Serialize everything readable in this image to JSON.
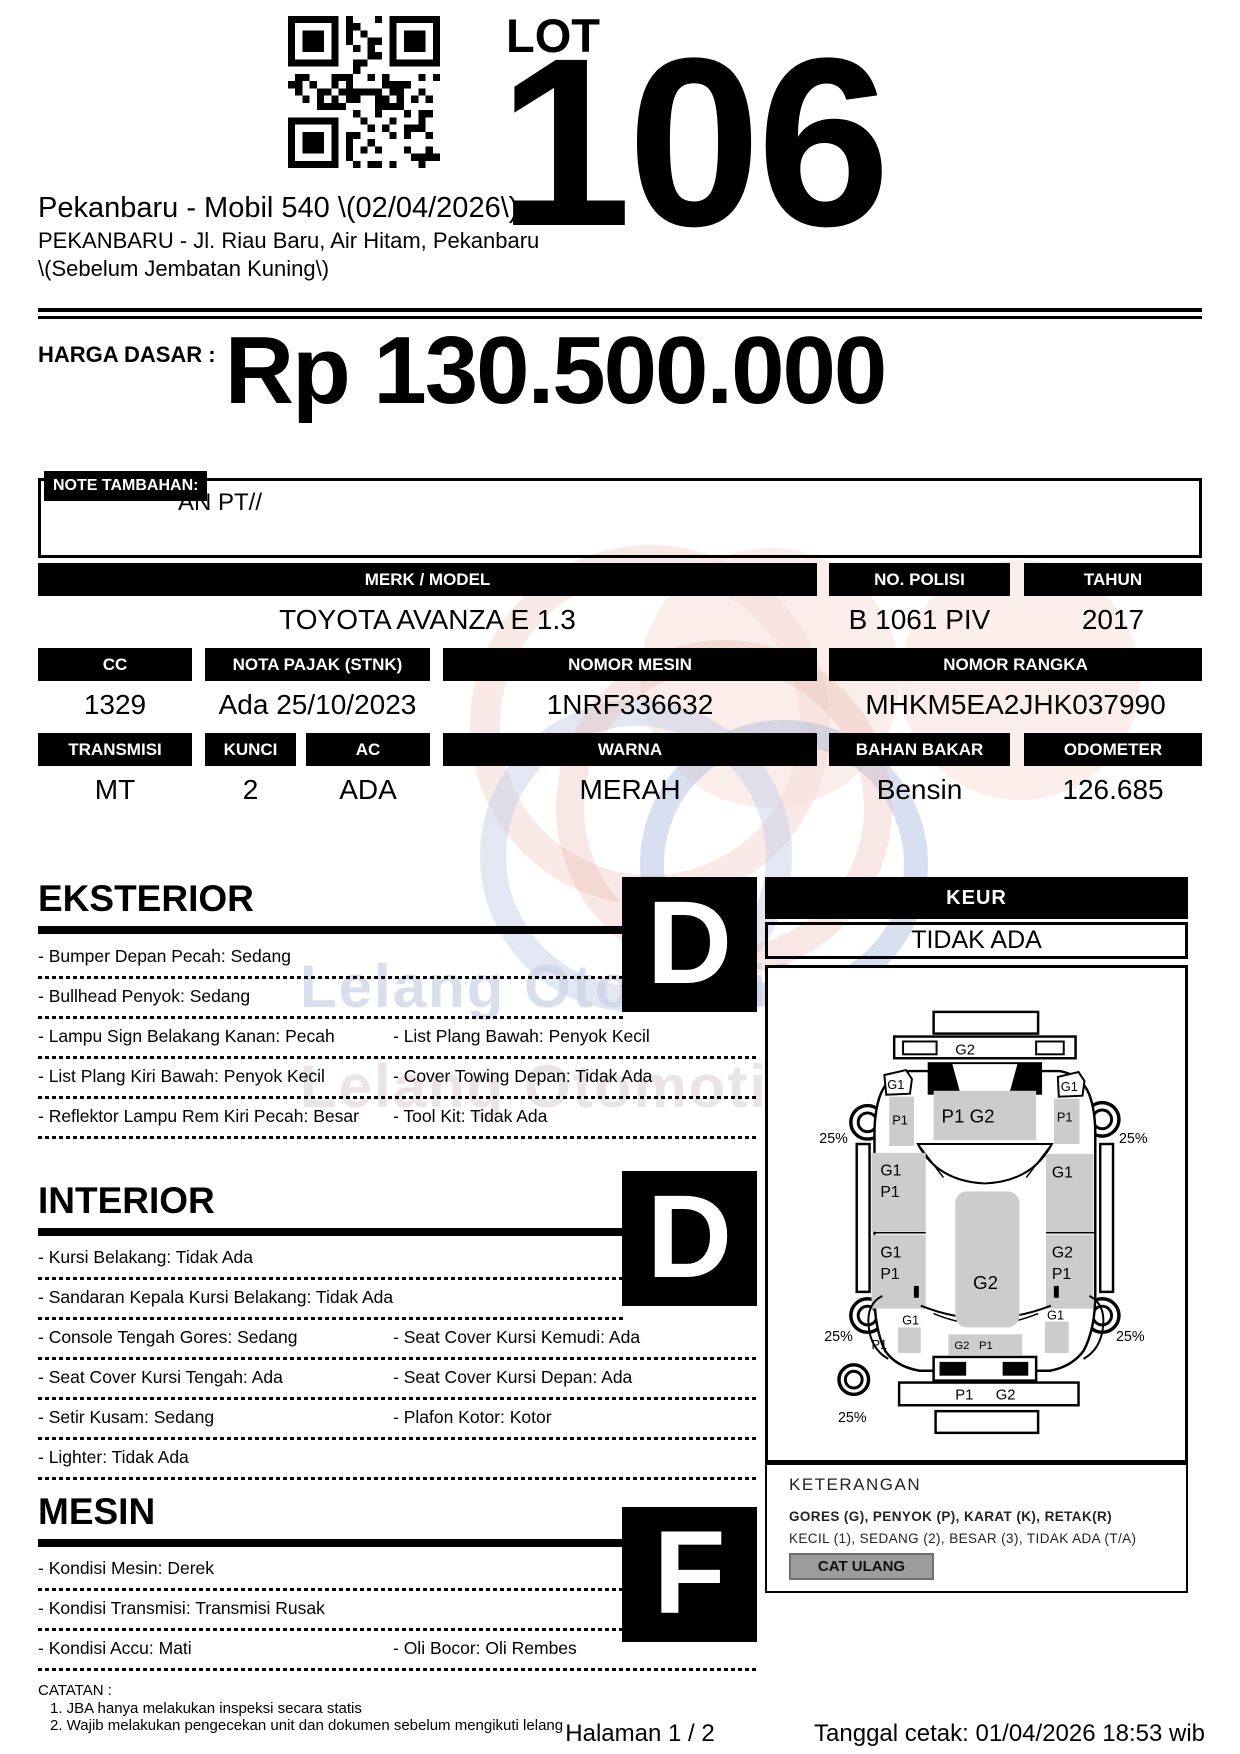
{
  "header": {
    "lot_label": "LOT",
    "lot_number": "106",
    "title_line1": "Pekanbaru - Mobil 540 \\(02/04/2026\\)",
    "title_line2": "PEKANBARU - Jl. Riau Baru, Air Hitam, Pekanbaru",
    "title_line3": "\\(Sebelum Jembatan Kuning\\)"
  },
  "price": {
    "label": "HARGA DASAR :",
    "value": "Rp 130.500.000"
  },
  "note": {
    "label": "NOTE TAMBAHAN:",
    "value": "AN PT//"
  },
  "specs": {
    "merk_model": {
      "label": "MERK / MODEL",
      "value": "TOYOTA AVANZA E 1.3"
    },
    "no_polisi": {
      "label": "NO. POLISI",
      "value": "B 1061 PIV"
    },
    "tahun": {
      "label": "TAHUN",
      "value": "2017"
    },
    "cc": {
      "label": "CC",
      "value": "1329"
    },
    "nota_pajak": {
      "label": "NOTA PAJAK (STNK)",
      "value": "Ada 25/10/2023"
    },
    "nomor_mesin": {
      "label": "NOMOR MESIN",
      "value": "1NRF336632"
    },
    "nomor_rangka": {
      "label": "NOMOR RANGKA",
      "value": "MHKM5EA2JHK037990"
    },
    "transmisi": {
      "label": "TRANSMISI",
      "value": "MT"
    },
    "kunci": {
      "label": "KUNCI",
      "value": "2"
    },
    "ac": {
      "label": "AC",
      "value": "ADA"
    },
    "warna": {
      "label": "WARNA",
      "value": "MERAH"
    },
    "bahan_bakar": {
      "label": "BAHAN BAKAR",
      "value": "Bensin"
    },
    "odometer": {
      "label": "ODOMETER",
      "value": "126.685"
    }
  },
  "keur": {
    "label": "KEUR",
    "value": "TIDAK ADA"
  },
  "sections": {
    "eksterior": {
      "title": "EKSTERIOR",
      "grade": "D",
      "rows": [
        {
          "left": "- Bumper Depan Pecah: Sedang",
          "right": ""
        },
        {
          "left": "- Bullhead Penyok: Sedang",
          "right": ""
        },
        {
          "left": "- Lampu Sign Belakang Kanan: Pecah",
          "right": "- List Plang Bawah: Penyok Kecil"
        },
        {
          "left": "- List Plang Kiri Bawah: Penyok Kecil",
          "right": "- Cover Towing Depan: Tidak Ada"
        },
        {
          "left": "- Reflektor Lampu Rem Kiri Pecah: Besar",
          "right": "- Tool Kit: Tidak Ada"
        }
      ]
    },
    "interior": {
      "title": "INTERIOR",
      "grade": "D",
      "rows": [
        {
          "left": "- Kursi Belakang: Tidak Ada",
          "right": ""
        },
        {
          "left": "- Sandaran Kepala Kursi Belakang: Tidak Ada",
          "right": ""
        },
        {
          "left": "- Console Tengah Gores: Sedang",
          "right": "- Seat Cover Kursi Kemudi: Ada"
        },
        {
          "left": "- Seat Cover Kursi Tengah: Ada",
          "right": "- Seat Cover Kursi Depan: Ada"
        },
        {
          "left": "- Setir Kusam: Sedang",
          "right": "- Plafon Kotor: Kotor"
        },
        {
          "left": "- Lighter: Tidak Ada",
          "right": ""
        }
      ]
    },
    "mesin": {
      "title": "MESIN",
      "grade": "F",
      "rows": [
        {
          "left": "- Kondisi Mesin: Derek",
          "right": ""
        },
        {
          "left": "- Kondisi Transmisi: Transmisi Rusak",
          "right": ""
        },
        {
          "left": "- Kondisi Accu: Mati",
          "right": "- Oli Bocor: Oli Rembes"
        }
      ]
    }
  },
  "diagram": {
    "wheel_pct": "25%",
    "labels": {
      "rear_bumper": "G2",
      "tailgate": "P1 G2",
      "rear_left_flag": "G1",
      "rear_left_patch": "P1",
      "rear_right_flag": "G1",
      "rear_right_patch": "P1",
      "left_door1_g": "G1",
      "left_door1_p": "P1",
      "left_door2_g": "G1",
      "left_door2_p": "P1",
      "roof": "G2",
      "right_door1": "G1",
      "right_door2_g": "G2",
      "right_door2_p": "P1",
      "front_left_fender_g": "G1",
      "front_left_fender_p": "P1",
      "front_right_fender_g": "G1",
      "hood_g": "G2",
      "hood_p": "P1",
      "front_bumper_p": "P1",
      "front_bumper_g": "G2"
    }
  },
  "keterangan": {
    "title": "KETERANGAN",
    "line1": "GORES (G), PENYOK (P), KARAT (K), RETAK(R)",
    "line2": "KECIL (1), SEDANG (2), BESAR (3), TIDAK ADA (T/A)",
    "badge": "CAT ULANG"
  },
  "catatan": {
    "label": "CATATAN :",
    "items": [
      "1. JBA hanya melakukan inspeksi secara statis",
      "2. Wajib melakukan pengecekan unit dan dokumen sebelum mengikuti lelang"
    ]
  },
  "footer": {
    "page": "Halaman 1 / 2",
    "printed": "Tanggal cetak: 01/04/2026 18:53 wib"
  },
  "watermark": {
    "line1": "Lelang Otomotif No.1",
    "line2": "Lelang Otomotif"
  },
  "colors": {
    "ink": "#000000",
    "patch_gray": "#cccccc",
    "badge_gray": "#9c9c9c"
  }
}
